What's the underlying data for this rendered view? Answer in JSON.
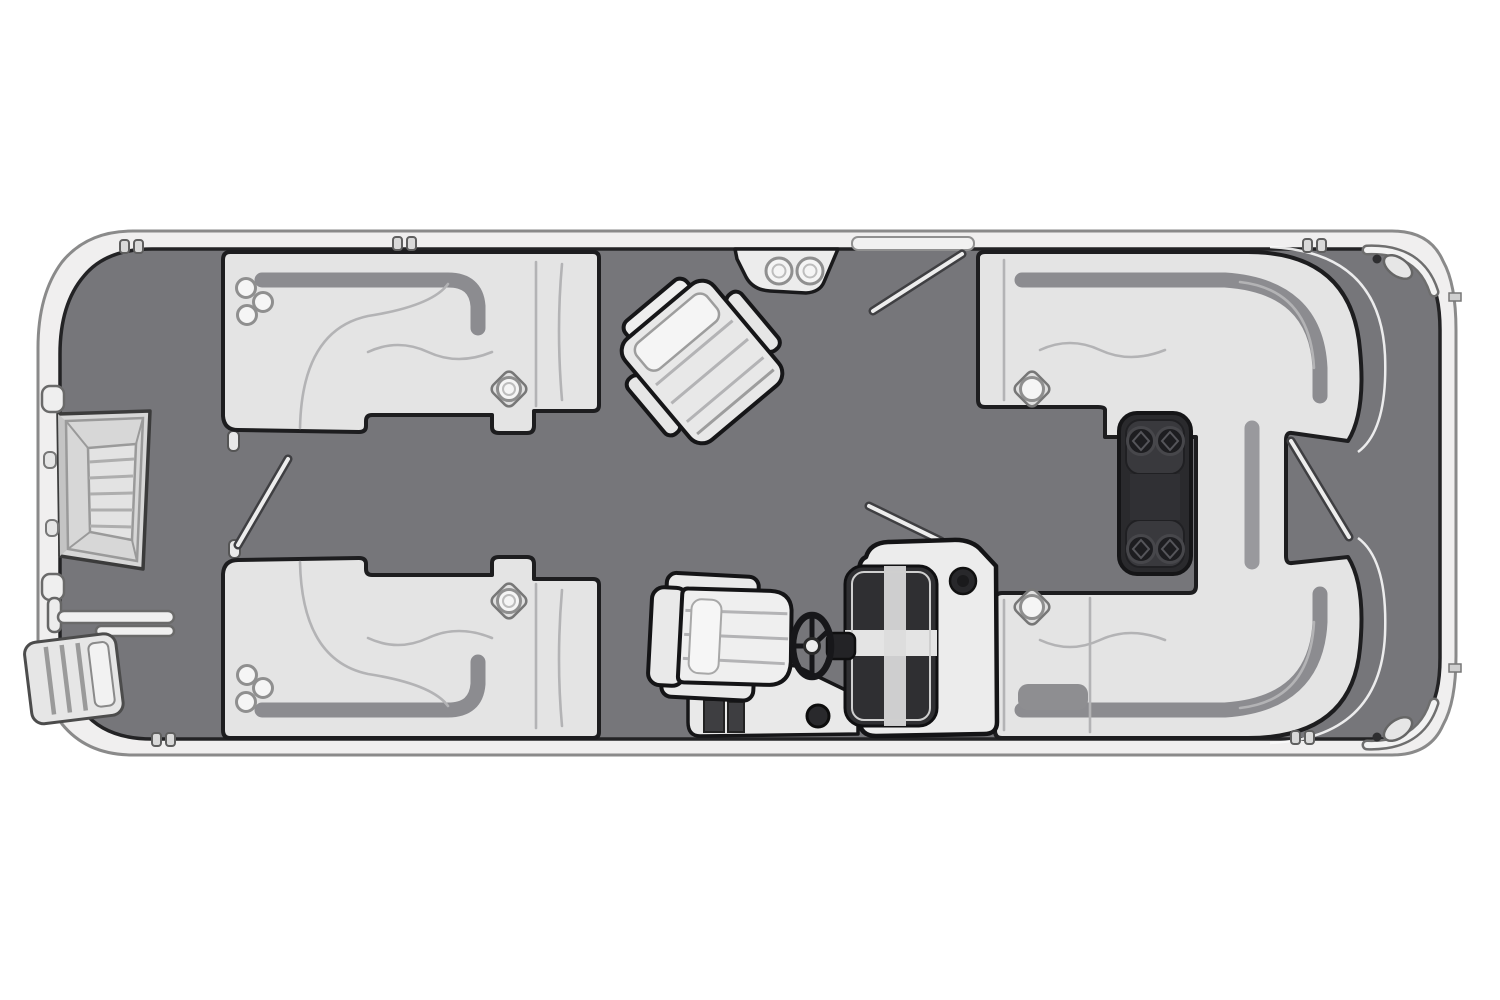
{
  "diagram": {
    "label": "Pontoon boat deck floor plan, top view, bow at left",
    "canvas": {
      "width": 1500,
      "height": 1000
    },
    "colors": {
      "background": "#ffffff",
      "deck": "#76767a",
      "deck_outline": "#232325",
      "hull_rail": "#f0efef",
      "hull_stroke": "#8a8a8a",
      "seat_fill": "#e4e4e4",
      "seat_highlight": "#f7f7f7",
      "seat_shadow": "#8c8c90",
      "outline": "#1d1d1f",
      "table_fill": "#2a2a2d",
      "table_detail": "#39393d",
      "windshield": "#2f2f32",
      "dark_detail": "#3e3e41",
      "gate_line": "#ededed"
    },
    "components": [
      {
        "id": "hull-fence",
        "label": "Hull and perimeter fence rail"
      },
      {
        "id": "deck",
        "label": "Main deck floor"
      },
      {
        "id": "bow-gate",
        "label": "Bow boarding gate with step panel"
      },
      {
        "id": "boarding-ladder",
        "label": "Boarding ladder outside bow corner"
      },
      {
        "id": "lounge-front-top",
        "label": "Front curved lounge seat, top side",
        "cupholders": 4
      },
      {
        "id": "lounge-front-bottom",
        "label": "Front curved lounge seat, bottom side",
        "cupholders": 4
      },
      {
        "id": "stern-lounge",
        "label": "Wraparound stern U-lounge",
        "cupholders": 2
      },
      {
        "id": "stern-table",
        "label": "Removable cocktail table",
        "cupholders": 4
      },
      {
        "id": "bow-cupholder-console",
        "label": "Top wall console with two cupholders",
        "cupholders": 2
      },
      {
        "id": "recliner-chair",
        "label": "Angled recliner chair"
      },
      {
        "id": "captain-chair",
        "label": "Captain's chair"
      },
      {
        "id": "steering-wheel",
        "label": "Steering wheel"
      },
      {
        "id": "helm-console",
        "label": "Helm console with windscreen"
      },
      {
        "id": "gate-top",
        "label": "Open side gate on top rail"
      },
      {
        "id": "gate-left",
        "label": "Open gate near front lounges"
      },
      {
        "id": "gate-stern",
        "label": "Open stern side gate"
      },
      {
        "id": "cleats",
        "label": "Rail cleat marks",
        "count": 5
      },
      {
        "id": "stern-corner-rails",
        "label": "Stern corner rail fittings",
        "count": 2
      }
    ]
  }
}
